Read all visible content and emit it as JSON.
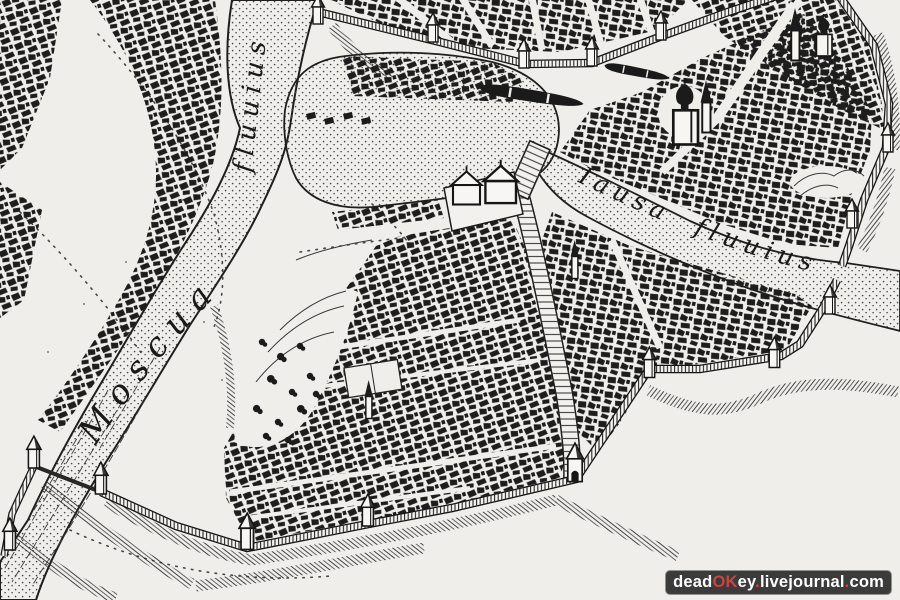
{
  "labels": {
    "moskva_river_name": "Moscua",
    "moskva_river_type": "fluuius",
    "yauza_river_name": "Iausa",
    "yauza_river_type": "fluuius"
  },
  "watermark": {
    "full_text": "deadOKey.livejournal.com",
    "seg_dead": "dead",
    "seg_ok": "OK",
    "seg_ey": "ey",
    "seg_dot1": ".",
    "seg_livejournal": "livejournal",
    "seg_dot2": ".",
    "seg_com": "com",
    "background_color": "#3b3b3b",
    "text_color": "#ffffff",
    "accent_color": "#c9453f"
  },
  "colors": {
    "paper": "#efeeeb",
    "ink": "#1b1b1b",
    "water_stipple": "#474747"
  }
}
